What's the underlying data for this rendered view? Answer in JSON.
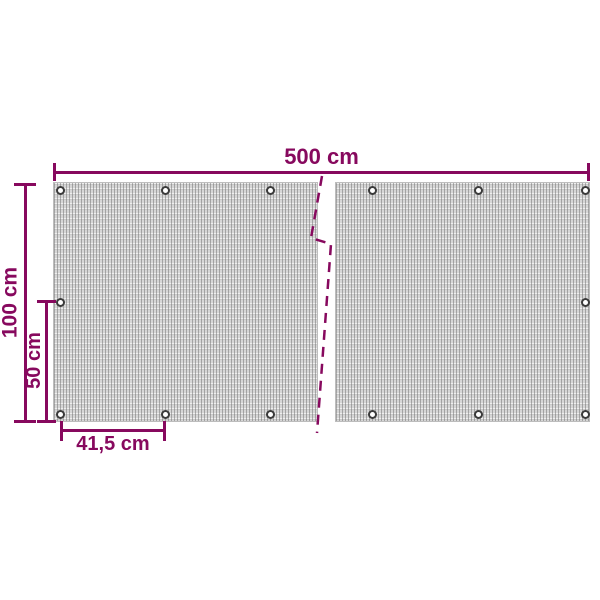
{
  "diagram": {
    "kind": "product-dimension-diagram",
    "subject": "mesh privacy screen panels with grommets",
    "accent_color": "#87095e",
    "mesh_color": "#d6d6d6",
    "panel_count": 2,
    "grommet_count": 14,
    "dimensions": {
      "total_width": "500 cm",
      "total_height": "100 cm",
      "half_height": "50 cm",
      "grommet_spacing": "41,5 cm"
    }
  }
}
